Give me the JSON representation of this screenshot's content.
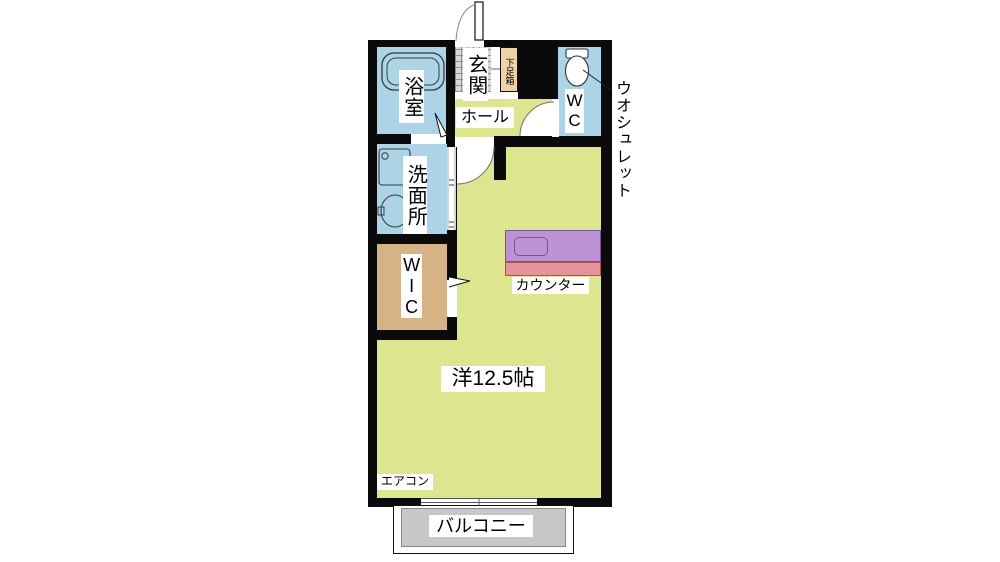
{
  "plan": {
    "rooms": {
      "bathroom": {
        "label": "浴室"
      },
      "entrance": {
        "label": "玄関"
      },
      "shoe_box": {
        "label": "下足箱"
      },
      "toilet_room": {
        "label": "WC"
      },
      "hall": {
        "label": "ホール"
      },
      "washroom": {
        "label": "洗面所"
      },
      "walk_in_closet": {
        "label": "WIC"
      },
      "main_room": {
        "label": "洋12.5帖"
      },
      "balcony": {
        "label": "バルコニー"
      }
    },
    "annotations": {
      "washlet": "ウオシュレット",
      "counter": "カウンター",
      "air_conditioner": "エアコン"
    },
    "fixtures": [
      "bathtub",
      "washing-machine-pan",
      "sink",
      "toilet",
      "entry-door",
      "bathroom-door",
      "folding-door",
      "closet-door",
      "wc-door-swing",
      "room-door-swing",
      "sliding-window"
    ],
    "colors": {
      "wall": "#0a0a0a",
      "wet_rooms": "#abd4e6",
      "living_area": "#dde58f",
      "closet": "#d6b285",
      "shoe_box": "#ecd3a6",
      "entrance_tile": "#d8d8d8",
      "counter_top": "#bd93d8",
      "counter_front": "#e8939b",
      "balcony": "#c7c7c7"
    }
  }
}
